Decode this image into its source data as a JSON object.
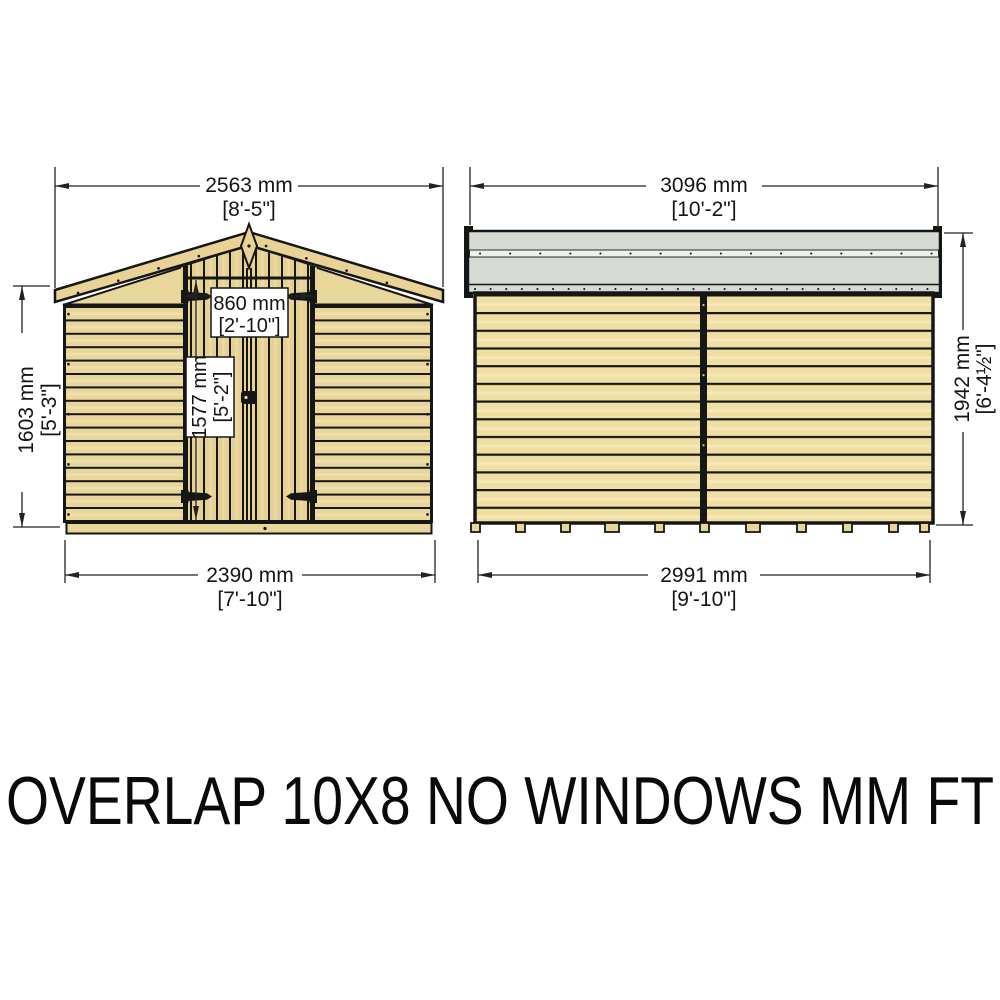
{
  "title": "OVERLAP 10X8 NO WINDOWS MM FT",
  "front_view": {
    "roof_width_mm": "2563 mm",
    "roof_width_ft": "[8'-5\"]",
    "door_width_mm": "860 mm",
    "door_width_ft": "[2'-10\"]",
    "door_height_mm": "1577 mm",
    "door_height_ft": "[5'-2\"]",
    "wall_height_mm": "1603 mm",
    "wall_height_ft": "[5'-3\"]",
    "base_width_mm": "2390 mm",
    "base_width_ft": "[7'-10\"]"
  },
  "side_view": {
    "roof_width_mm": "3096 mm",
    "roof_width_ft": "[10'-2\"]",
    "height_mm": "1942 mm",
    "height_ft": "[6'-4½\"]",
    "base_width_mm": "2991 mm",
    "base_width_ft": "[9'-10\"]"
  },
  "colors": {
    "wood": "#e9d69a",
    "wood_light": "#f0dfa2",
    "roof_felt": "#d6dcd4",
    "outline": "#161616",
    "background": "#ffffff"
  }
}
